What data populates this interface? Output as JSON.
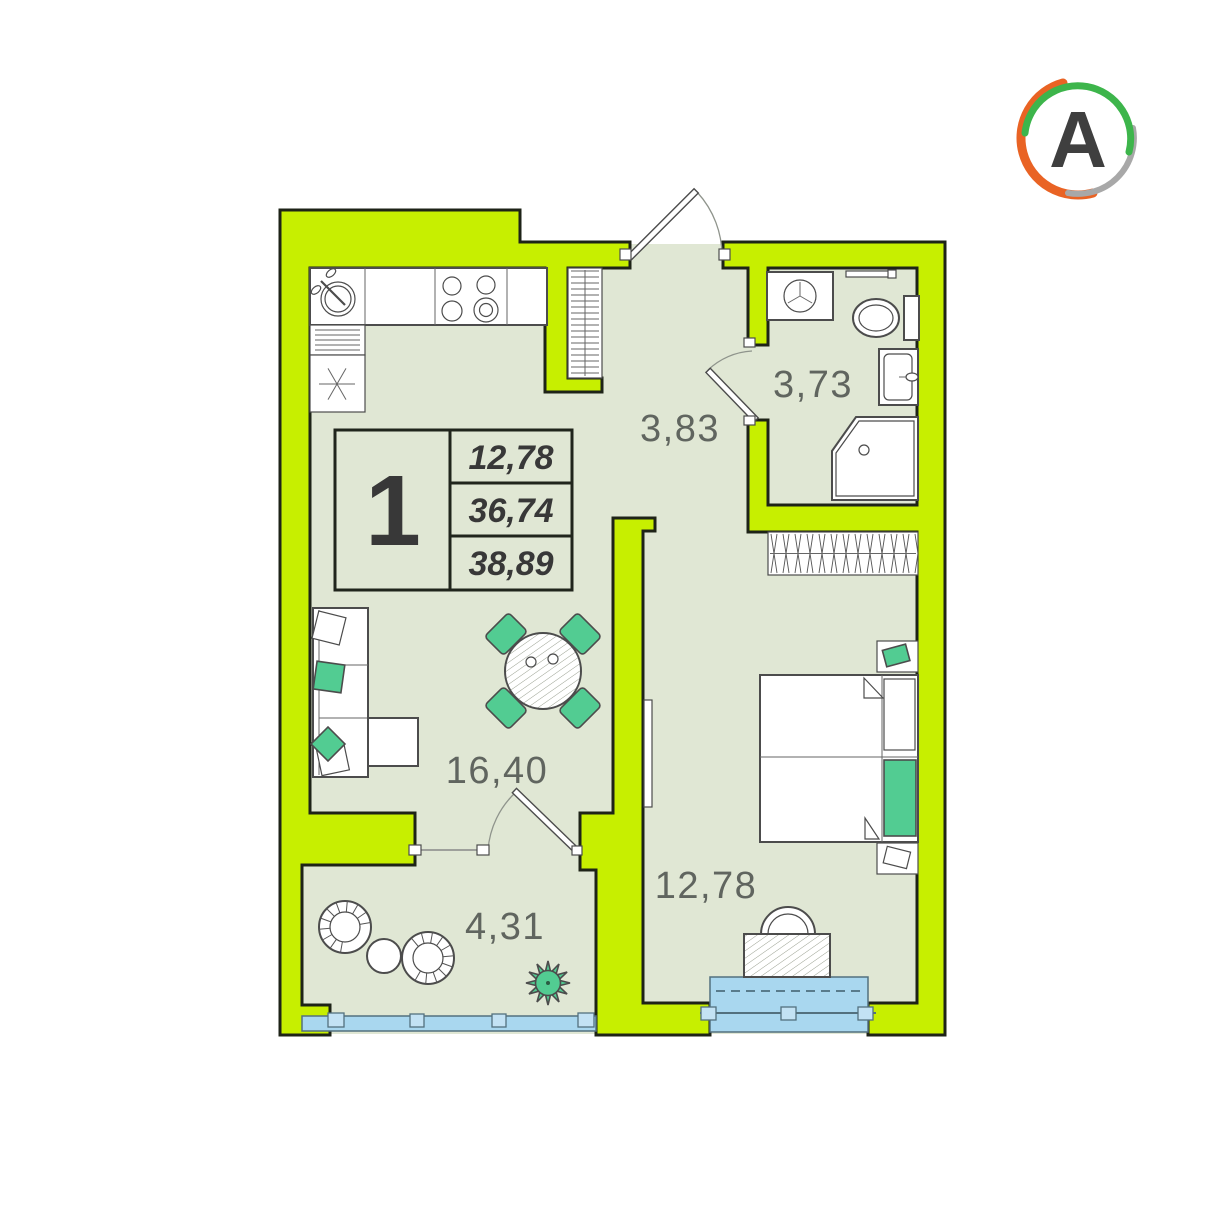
{
  "logo": {
    "letter": "A"
  },
  "unit": {
    "number_of_rooms": "1",
    "areas": {
      "living": "12,78",
      "apartment": "36,74",
      "total": "38,89"
    }
  },
  "rooms": [
    {
      "id": "hallway",
      "area": "3,83"
    },
    {
      "id": "bathroom",
      "area": "3,73"
    },
    {
      "id": "living-kitchen",
      "area": "16,40"
    },
    {
      "id": "bedroom",
      "area": "12,78"
    },
    {
      "id": "balcony",
      "area": "4,31"
    }
  ],
  "colors": {
    "wall": "#c7ef00",
    "floor": "#e0e7d4",
    "outline": "#1e2317",
    "accent": "#52cc92",
    "window": "#a9d7ef",
    "window_frame": "#53707e",
    "label": "#60655f",
    "number": "#383838",
    "furn": "#4c4c4c",
    "logo_orange": "#e96324",
    "logo_green": "#3db54b",
    "logo_gray": "#a8a8a8",
    "logo_letter": "#3f3f3f"
  }
}
